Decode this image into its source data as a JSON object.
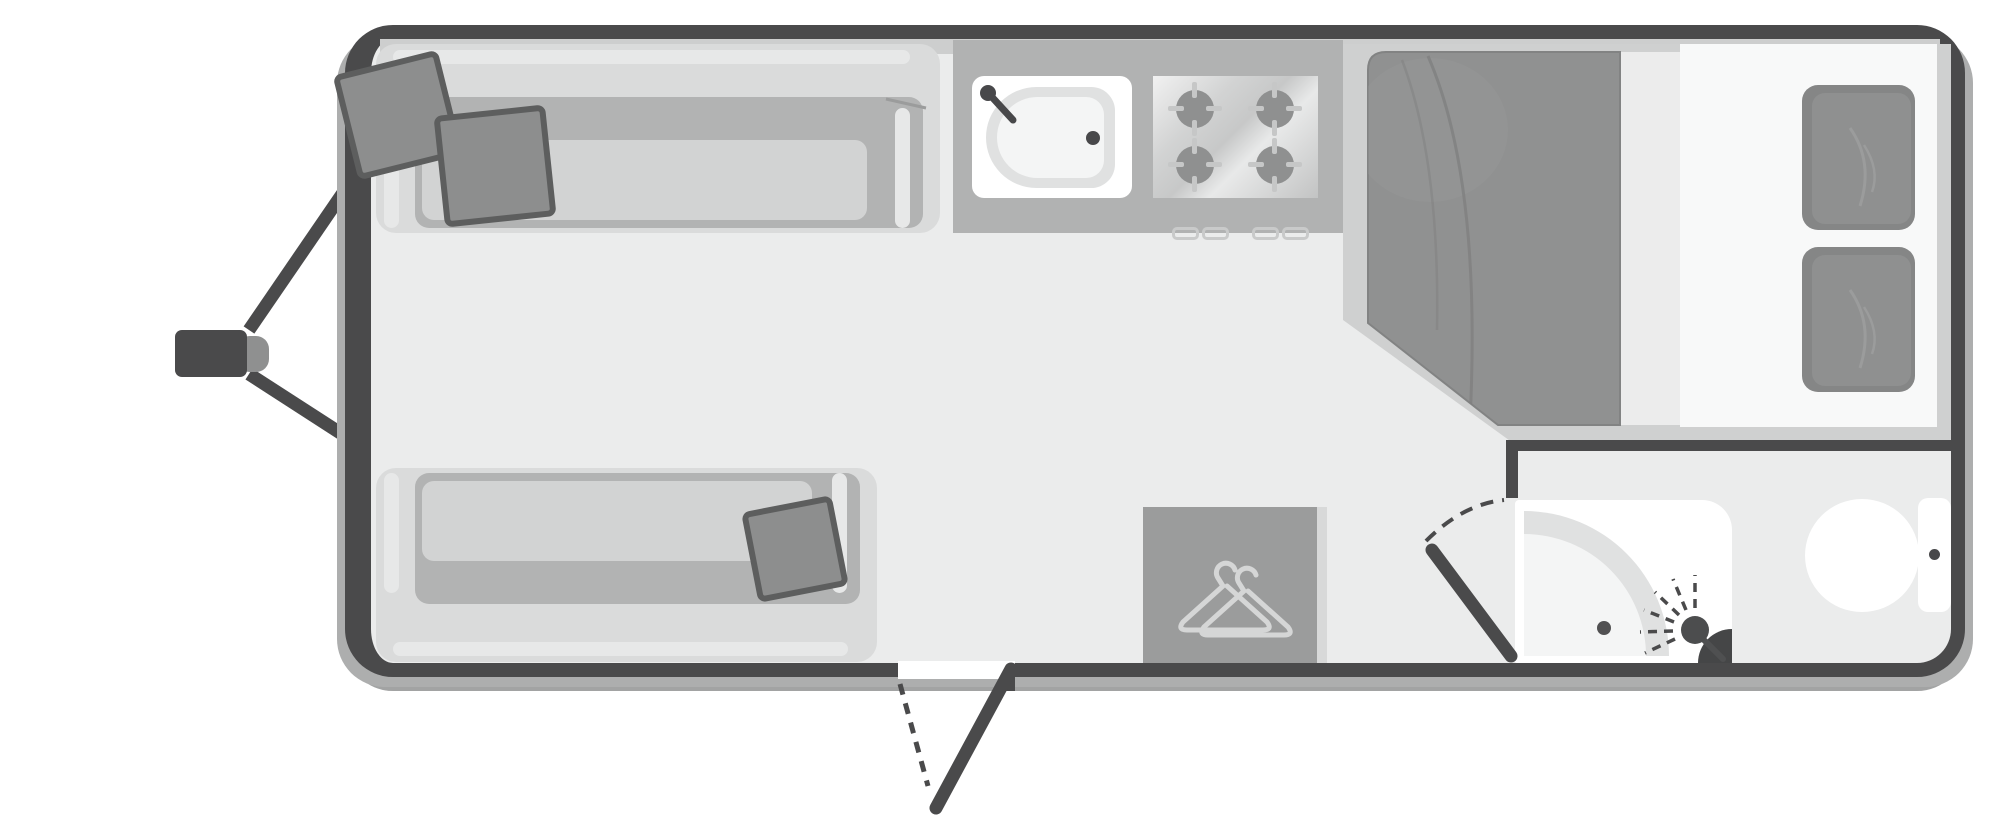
{
  "diagram": {
    "kind": "caravan-floorplan-top-view",
    "orientation": "hitch-left",
    "zones": {
      "lounge": {
        "sofas": 2,
        "scatter_cushions_front_sofa": 2,
        "scatter_cushions_rear_sofa": 1
      },
      "kitchen": {
        "sink": {
          "features": [
            "tap-icon",
            "drain-dot"
          ]
        },
        "hob_burners": 4,
        "unit_handles": 4
      },
      "bedroom": {
        "bed": "double-island-bed",
        "pillows": 2,
        "duvet_corner": "clipped-bottom-left"
      },
      "wardrobe": {
        "icon": "coat-hanger-icon",
        "hangers_in_icon": 2
      },
      "bathroom": {
        "fixtures": [
          "corner-shower",
          "shower-head-icon",
          "toilet"
        ],
        "door": "swing-door-with-dashed-arc"
      },
      "entry": {
        "door": "swing-door-with-dashed-arc",
        "position": "bottom-wall"
      },
      "exterior": {
        "tow_hitch": "a-frame-with-coupler"
      }
    },
    "palette": {
      "wall_dark": "#4a4a4b",
      "floor": "#ebecec",
      "wall_inner_bevel": "#cdcece",
      "sofa_light": "#dadbdb",
      "sofa_recess": "#b2b3b3",
      "seat_cushion": "#d2d3d3",
      "soft_furnishing_dark": "#8e8f8f",
      "cushion_outline": "#5d5e5e",
      "counter": "#b1b2b2",
      "fixture_white": "#ffffff",
      "duvet": "#909191",
      "wardrobe": "#9b9c9c",
      "hanger_stroke": "#d5d6d6",
      "shadow": "#adaeae"
    }
  }
}
